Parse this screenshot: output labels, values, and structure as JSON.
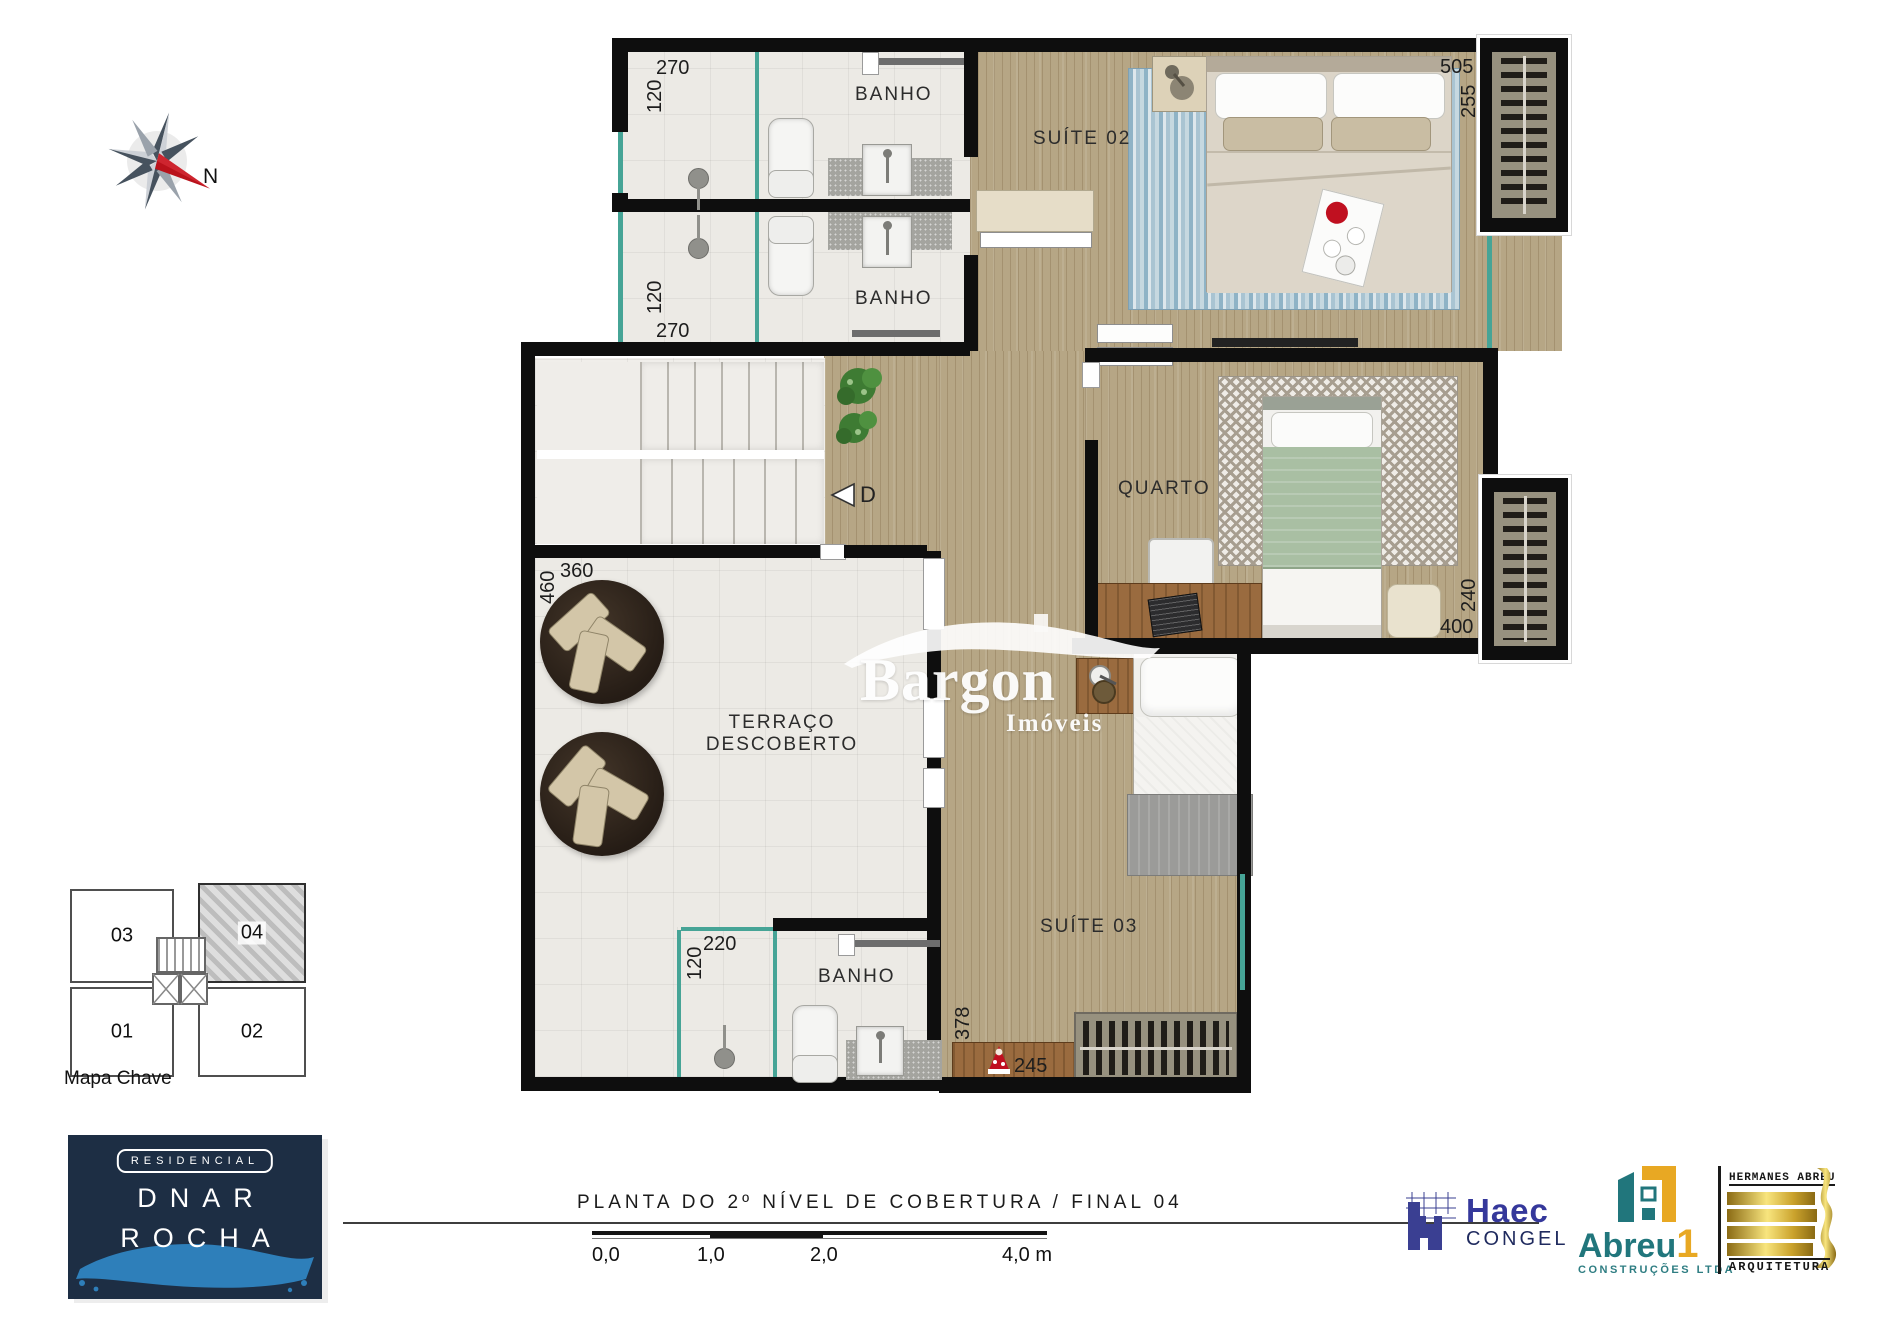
{
  "compass": {
    "label": "N"
  },
  "watermark": {
    "name": "Bargon",
    "tagline": "Imóveis"
  },
  "plan": {
    "stair_marker": "D",
    "rooms": {
      "banho_top": {
        "label": "BANHO",
        "dim_w": "270",
        "dim_h": "120"
      },
      "banho_mid": {
        "label": "BANHO",
        "dim_w": "270",
        "dim_h": "120"
      },
      "suite02": {
        "label": "SUÍTE 02",
        "dim_w": "505",
        "dim_h": "255"
      },
      "quarto": {
        "label": "QUARTO",
        "dim_w": "400",
        "dim_h": "240"
      },
      "terraco": {
        "label_line1": "TERRAÇO",
        "label_line2": "DESCOBERTO",
        "dim_w": "360",
        "dim_h": "460"
      },
      "banho_bottom": {
        "label": "BANHO",
        "dim_w": "220",
        "dim_h": "120"
      },
      "suite03": {
        "label": "SUÍTE 03",
        "dim_w": "245",
        "dim_h": "378"
      }
    }
  },
  "key_map": {
    "title": "Mapa Chave",
    "units": [
      {
        "id": "03"
      },
      {
        "id": "04"
      },
      {
        "id": "01"
      },
      {
        "id": "02"
      }
    ],
    "highlighted_unit": "04"
  },
  "branding": {
    "residencial_badge": "RESIDENCIAL",
    "name_line1": "DNAR",
    "name_line2": "ROCHA"
  },
  "footer": {
    "title": "PLANTA DO 2º NÍVEL DE COBERTURA / FINAL 04",
    "scale_labels": [
      "0,0",
      "1,0",
      "2,0",
      "4,0 m"
    ]
  },
  "partners": {
    "haec": {
      "name": "Haec",
      "subtitle": "CONGEL"
    },
    "abreu": {
      "name": "Abreu",
      "suffix": "1",
      "subtitle": "CONSTRUÇÕES LTDA"
    },
    "hermanes": {
      "top": "HERMANES ABREU",
      "bottom": "ARQUITETURA"
    }
  },
  "colors": {
    "wall": "#0e0e0e",
    "glass_accent": "#46a496",
    "wood_floor": "#b6a685",
    "navy_brand": "#1d2e44",
    "brush_blue": "#2e7fba",
    "haec_blue": "#35389b",
    "abreu_teal": "#21767c",
    "abreu_yellow": "#e8a823",
    "gold": "#caa22c",
    "compass_red": "#b9121b"
  }
}
